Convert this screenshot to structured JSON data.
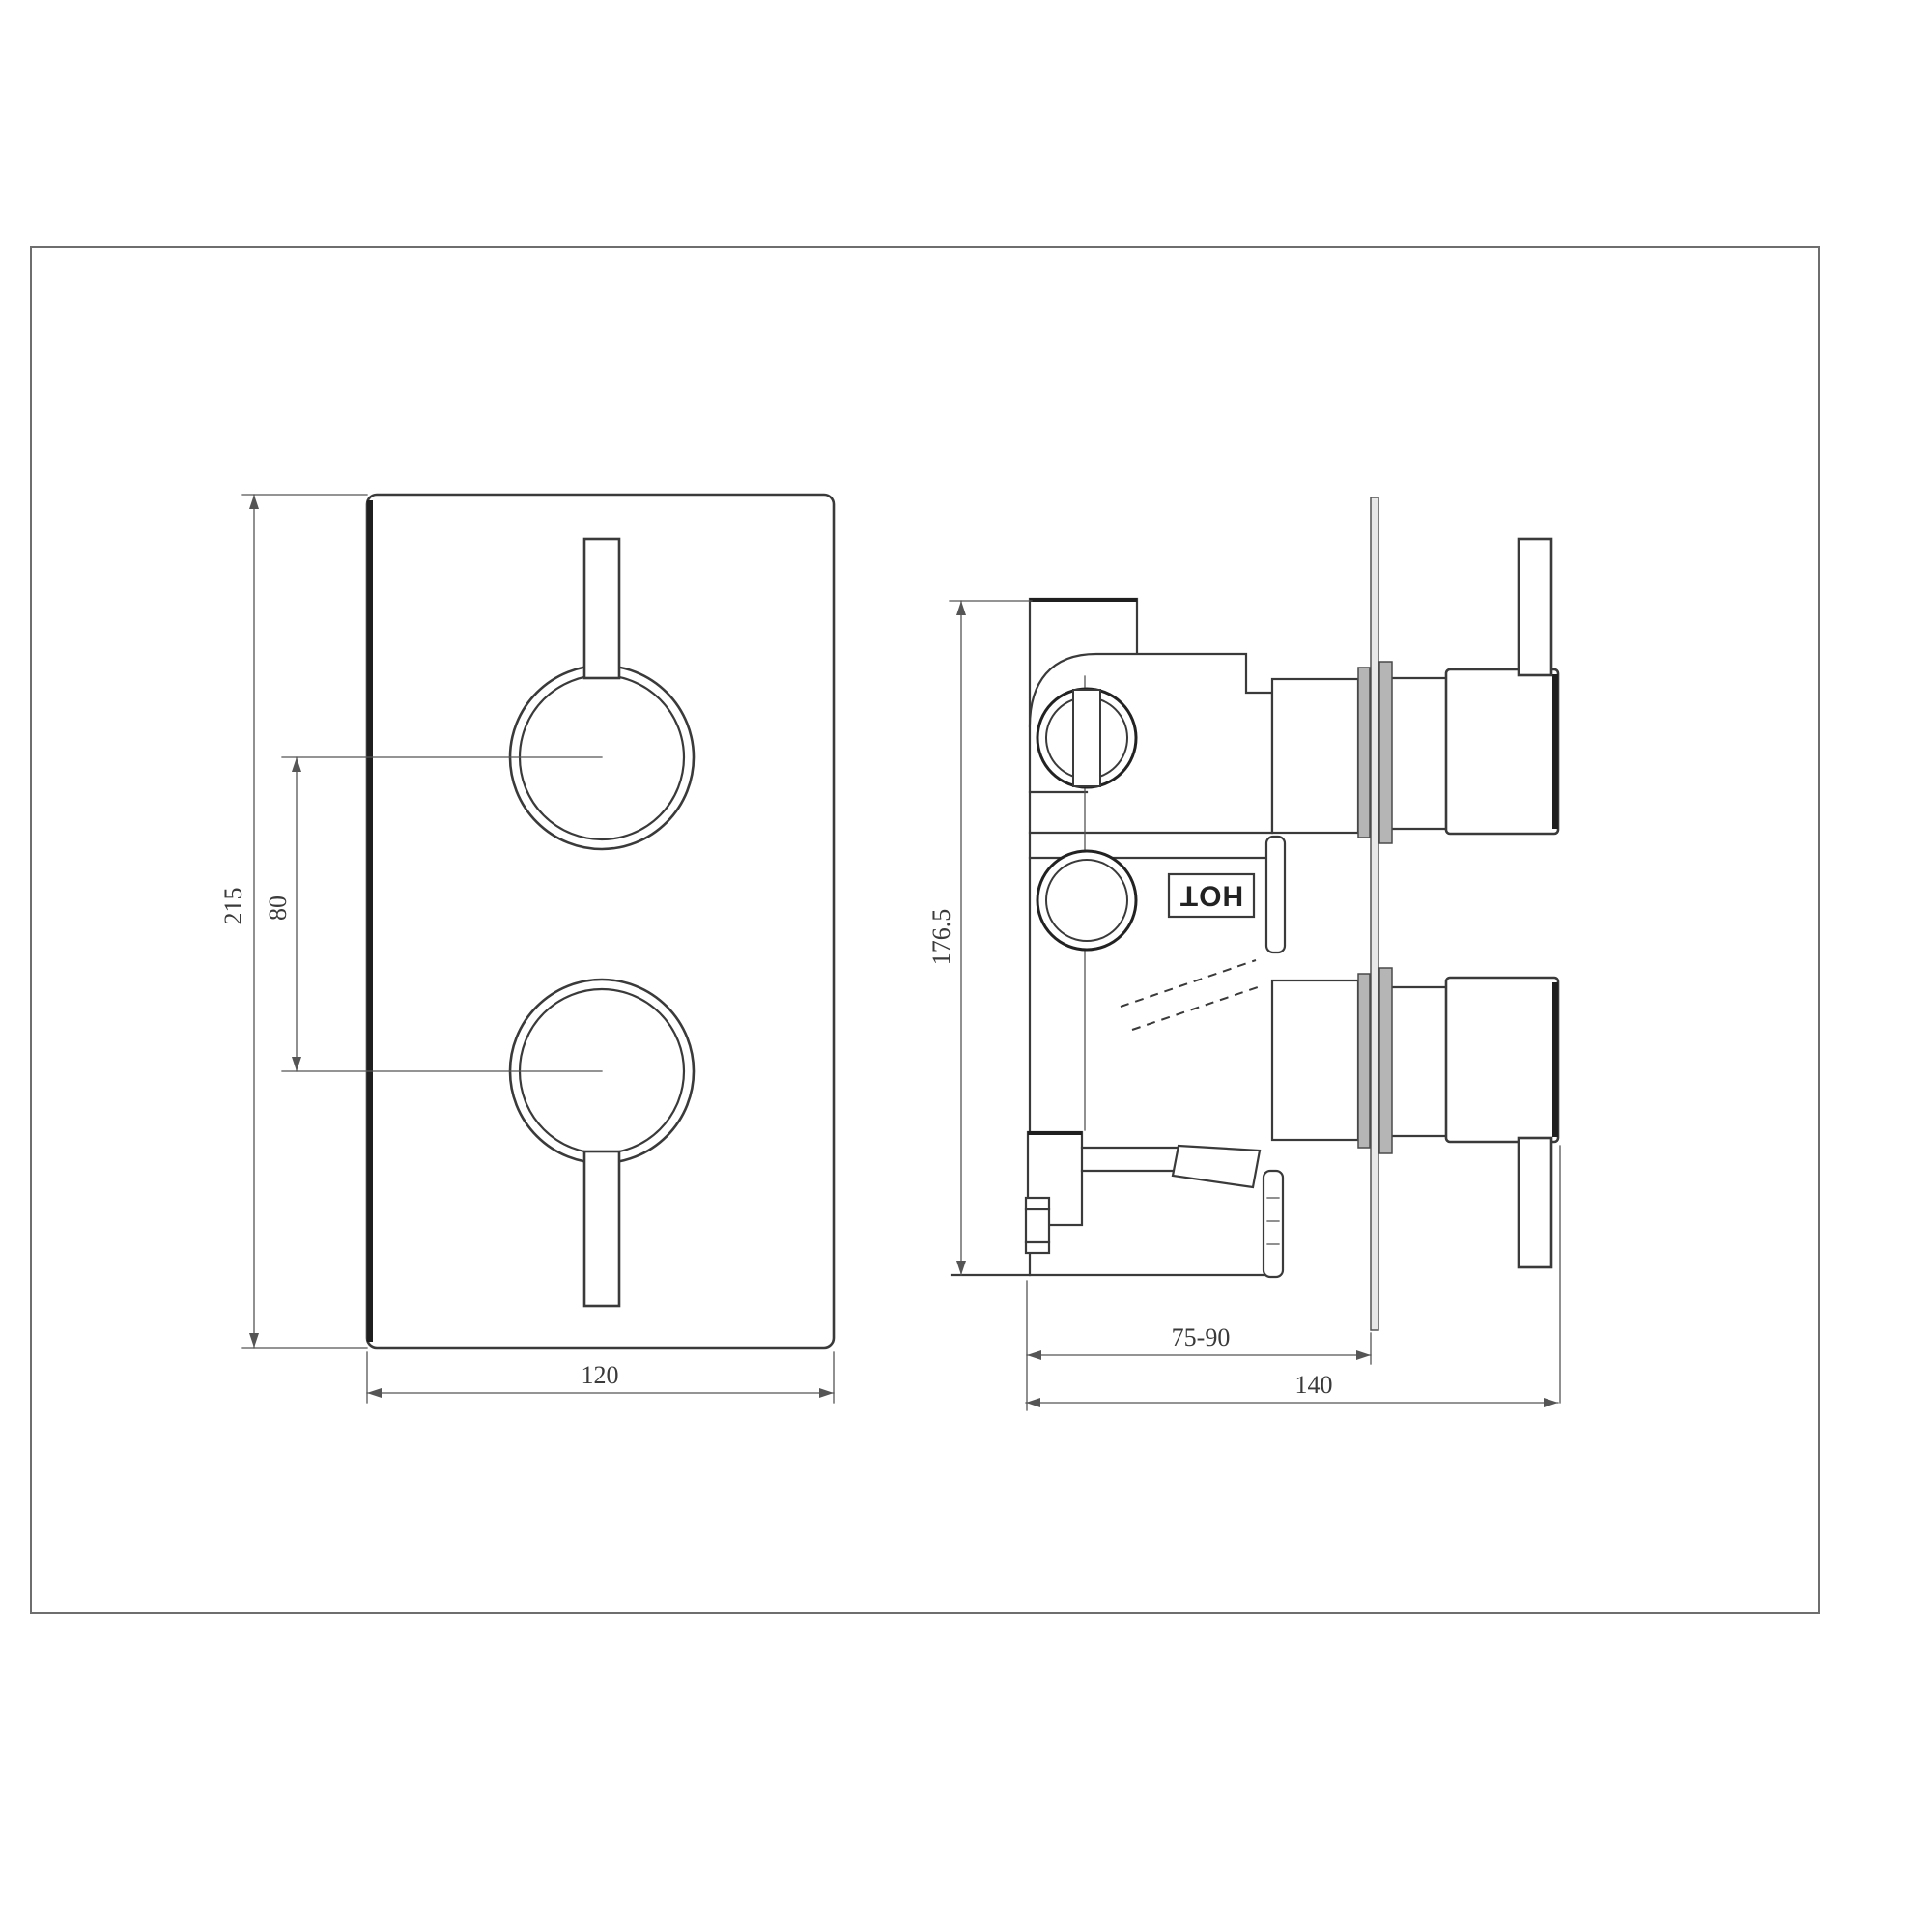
{
  "drawing": {
    "type": "technical-drawing",
    "subject": "concealed thermostatic shower valve, two handles",
    "views": {
      "front": {
        "label": "front-view",
        "dimensions": {
          "height": "215",
          "handle_spacing": "80",
          "width": "120"
        }
      },
      "side": {
        "label": "side-view",
        "dimensions": {
          "height": "176.5",
          "wall_depth_range": "75-90",
          "total_depth": "140"
        },
        "labels": {
          "hot": "HOT"
        }
      }
    },
    "colors": {
      "line": "#3a3a3a",
      "thick_edge": "#1f1f1f",
      "dim_line": "#555555",
      "collar_fill": "#b5b5b5",
      "plate_fill": "#e9e9e9",
      "border": "#6e6e6e",
      "background": "#ffffff"
    }
  }
}
